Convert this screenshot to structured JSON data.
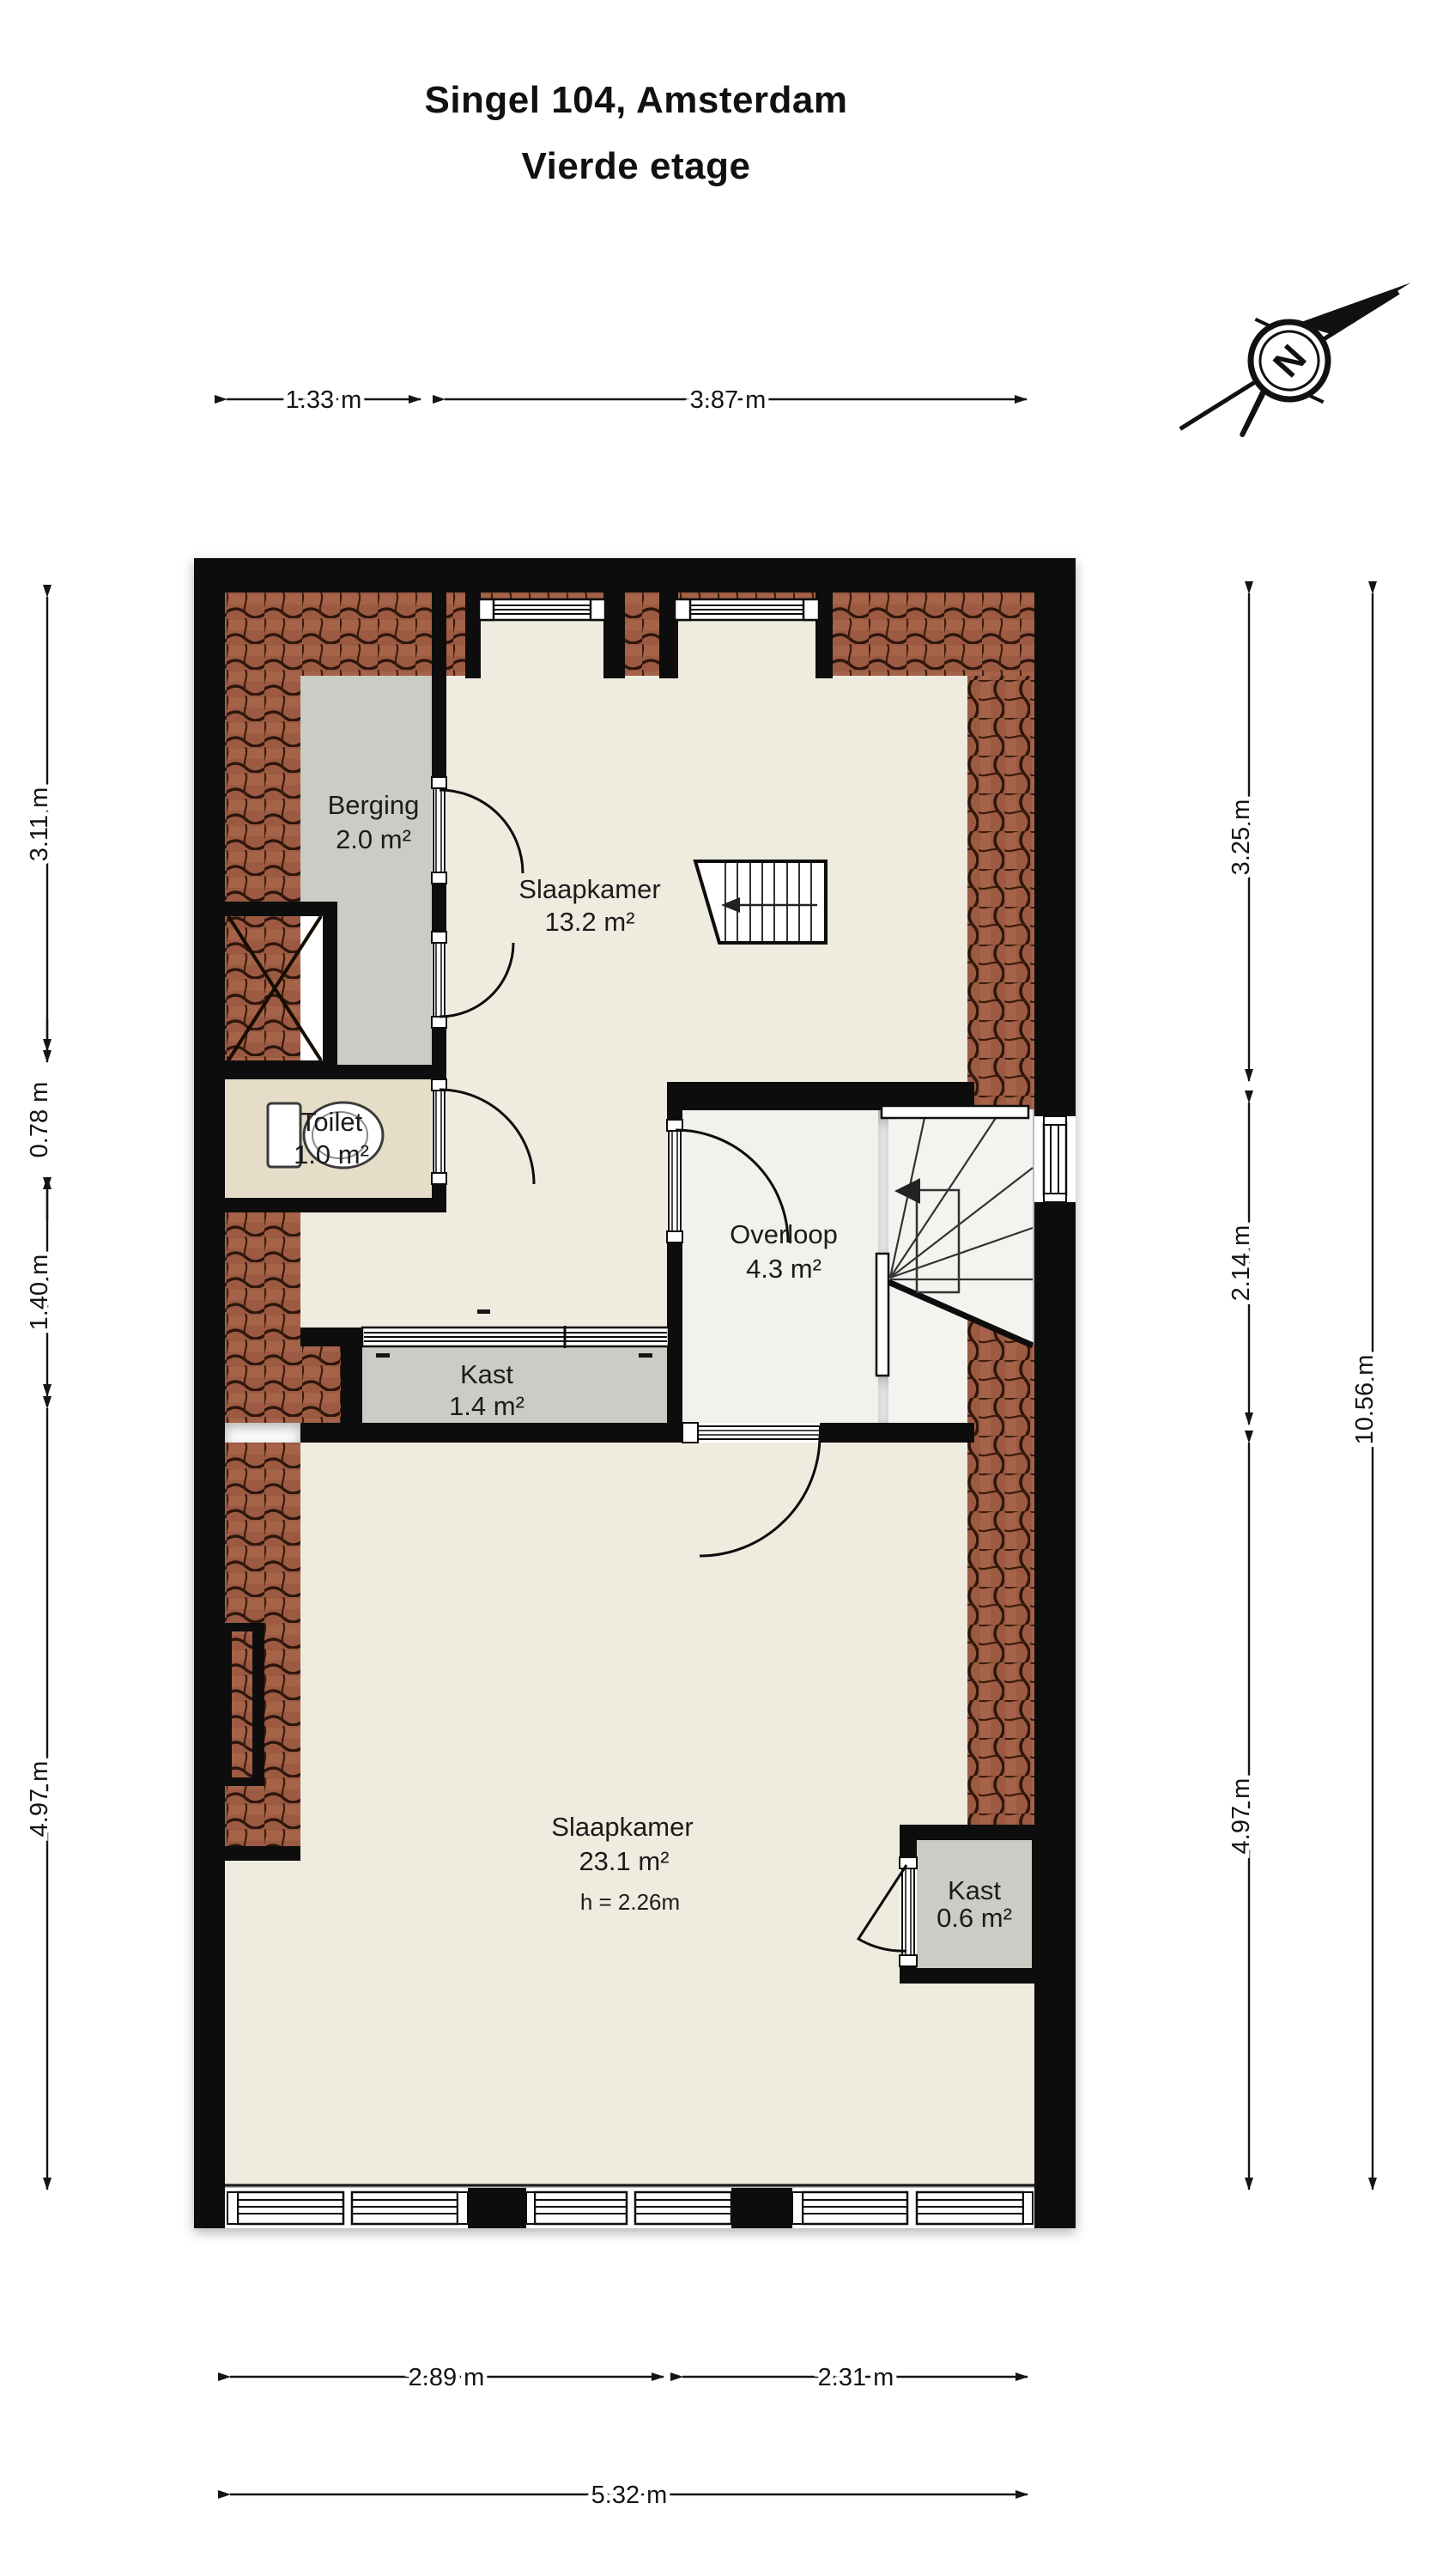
{
  "title": {
    "line1": "Singel 104, Amsterdam",
    "line2": "Vierde etage"
  },
  "compass": {
    "north": "N"
  },
  "rooms": {
    "berging": {
      "name": "Berging",
      "area": "2.0 m²"
    },
    "slaapkamer1": {
      "name": "Slaapkamer",
      "area": "13.2 m²"
    },
    "toilet": {
      "name": "Toilet",
      "area": "1.0 m²"
    },
    "overloop": {
      "name": "Overloop",
      "area": "4.3 m²"
    },
    "kast1": {
      "name": "Kast",
      "area": "1.4 m²"
    },
    "slaapkamer2": {
      "name": "Slaapkamer",
      "area": "23.1 m²",
      "height": "h = 2.26m"
    },
    "kast2": {
      "name": "Kast",
      "area": "0.6 m²"
    }
  },
  "dimensions": {
    "top": [
      "1.33 m",
      "3.87 m"
    ],
    "left": [
      "3.11 m",
      "0.78 m",
      "1.40 m",
      "4.97 m"
    ],
    "right": [
      "3.25 m",
      "2.14 m",
      "4.97 m"
    ],
    "right_total": "10.56 m",
    "bottom": [
      "2.89 m",
      "2.31 m"
    ],
    "bottom_total": "5.32 m"
  },
  "colors": {
    "wall": "#0a0a0a",
    "floor_cream": "#efebdf",
    "floor_gray": "#c9cdc5",
    "floor_tan": "#e6ddc9",
    "floor_light": "#f2f1ec",
    "tile_base": "#9c5a42",
    "tile_dark": "#2f150a"
  }
}
